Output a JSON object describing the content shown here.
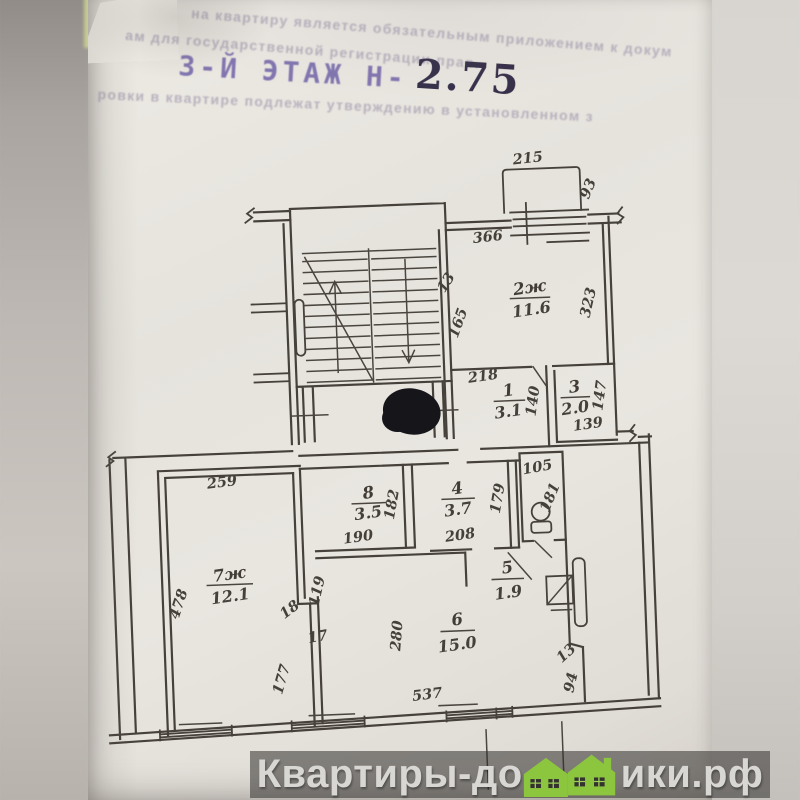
{
  "page": {
    "faint_line1": "на квартиру является обязательным приложением к докум",
    "faint_line2": "ам для государственной регистрации прав.",
    "faint_line3": "ровки в квартире подлежат утверждению в установленном з",
    "stamp_text": "3-Й ЭТАЖ Н-",
    "stamp_value": "2.75"
  },
  "plan": {
    "rooms": {
      "r2": {
        "num": "2ж",
        "area": "11.6"
      },
      "r1": {
        "num": "1",
        "area": "3.1"
      },
      "r3": {
        "num": "3",
        "area": "2.0"
      },
      "r7": {
        "num": "7ж",
        "area": "12.1"
      },
      "r8": {
        "num": "8",
        "area": "3.5"
      },
      "r4": {
        "num": "4",
        "area": "3.7"
      },
      "r5": {
        "num": "5",
        "area": "1.9"
      },
      "r6": {
        "num": "6",
        "area": "15.0"
      }
    },
    "dims": {
      "d215": "215",
      "d93": "93",
      "d366": "366",
      "d13a": "13",
      "d165": "165",
      "d323": "323",
      "d218": "218",
      "d140": "140",
      "d147": "147",
      "d139": "139",
      "d259": "259",
      "d478": "478",
      "d18": "18",
      "d119": "119",
      "d17": "17",
      "d177": "177",
      "d190": "190",
      "d182": "182",
      "d208": "208",
      "d179": "179",
      "d105": "105",
      "d181": "181",
      "d280": "280",
      "d537": "537",
      "d13b": "13",
      "d94": "94"
    }
  },
  "watermark": {
    "text_before": "Квартиры-до",
    "text_after": "ики.рф",
    "house_color": "#8cc63e"
  }
}
